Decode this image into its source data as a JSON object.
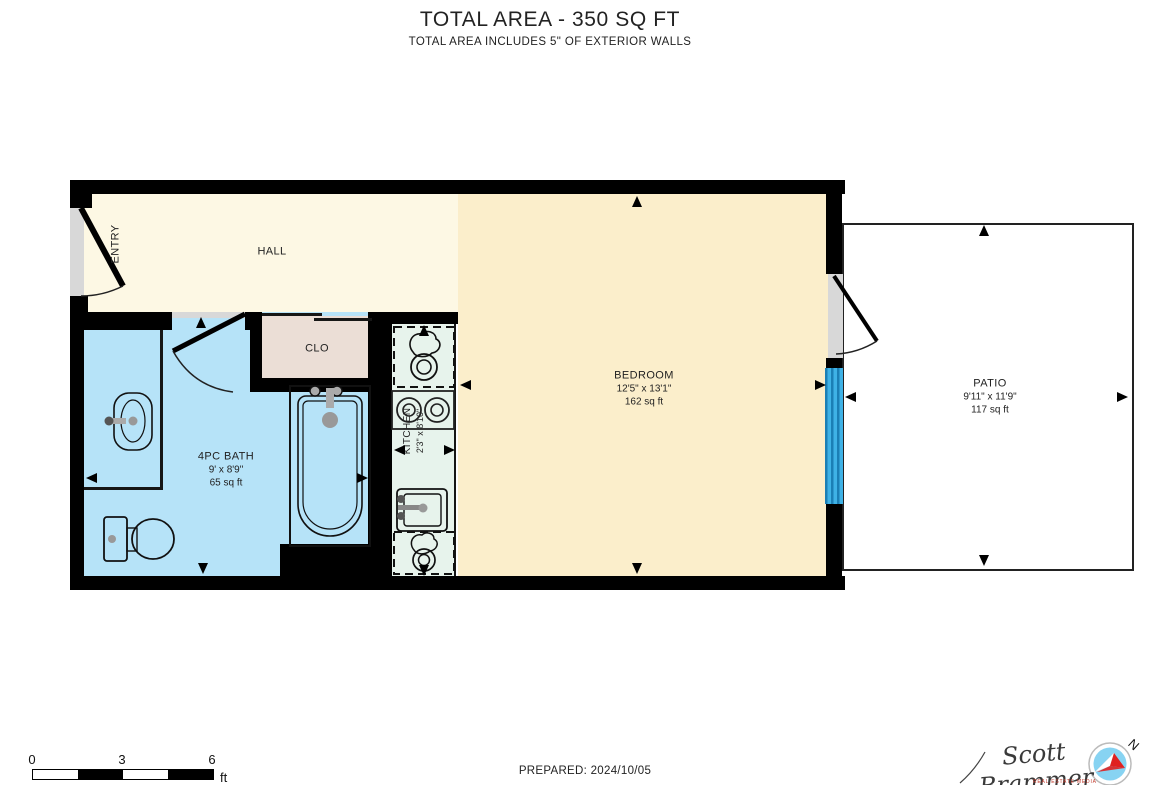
{
  "header": {
    "title": "TOTAL AREA - 350 SQ FT",
    "subtitle": "TOTAL AREA INCLUDES 5\" OF EXTERIOR WALLS"
  },
  "rooms": {
    "entry": {
      "label": "ENTRY"
    },
    "hall": {
      "label": "HALL"
    },
    "closet": {
      "label": "CLO"
    },
    "bath": {
      "label": "4PC BATH",
      "dims": "9' x 8'9\"",
      "area": "65 sq ft"
    },
    "kitchen": {
      "label": "KITCHEN",
      "dims": "2'3\" x 8'10\""
    },
    "bedroom": {
      "label": "BEDROOM",
      "dims": "12'5\" x 13'1\"",
      "area": "162 sq ft"
    },
    "patio": {
      "label": "PATIO",
      "dims": "9'11\" x 11'9\"",
      "area": "117 sq ft"
    }
  },
  "footer": {
    "prepared": "PREPARED: 2024/10/05",
    "scale": {
      "tick0": "0",
      "tick3": "3",
      "tick6": "6",
      "unit": "ft"
    },
    "signature": {
      "name": "Scott Brammer",
      "tagline": "REAL ESTATE MEDIA"
    },
    "compass_letter": "N"
  },
  "colors": {
    "wall": "#000000",
    "hall": "#FDF8E4",
    "bedroom": "#FBEECB",
    "bath": "#B6E3F8",
    "closet": "#EBDED6",
    "kitchen": "#E7F3EC",
    "patio": "#FFFFFF",
    "window_glass": "#3FB2E6",
    "door_recess": "#D8D8D8",
    "compass_blue": "#87D3F2",
    "compass_red": "#E02020",
    "tagline_red": "#C0392B"
  }
}
